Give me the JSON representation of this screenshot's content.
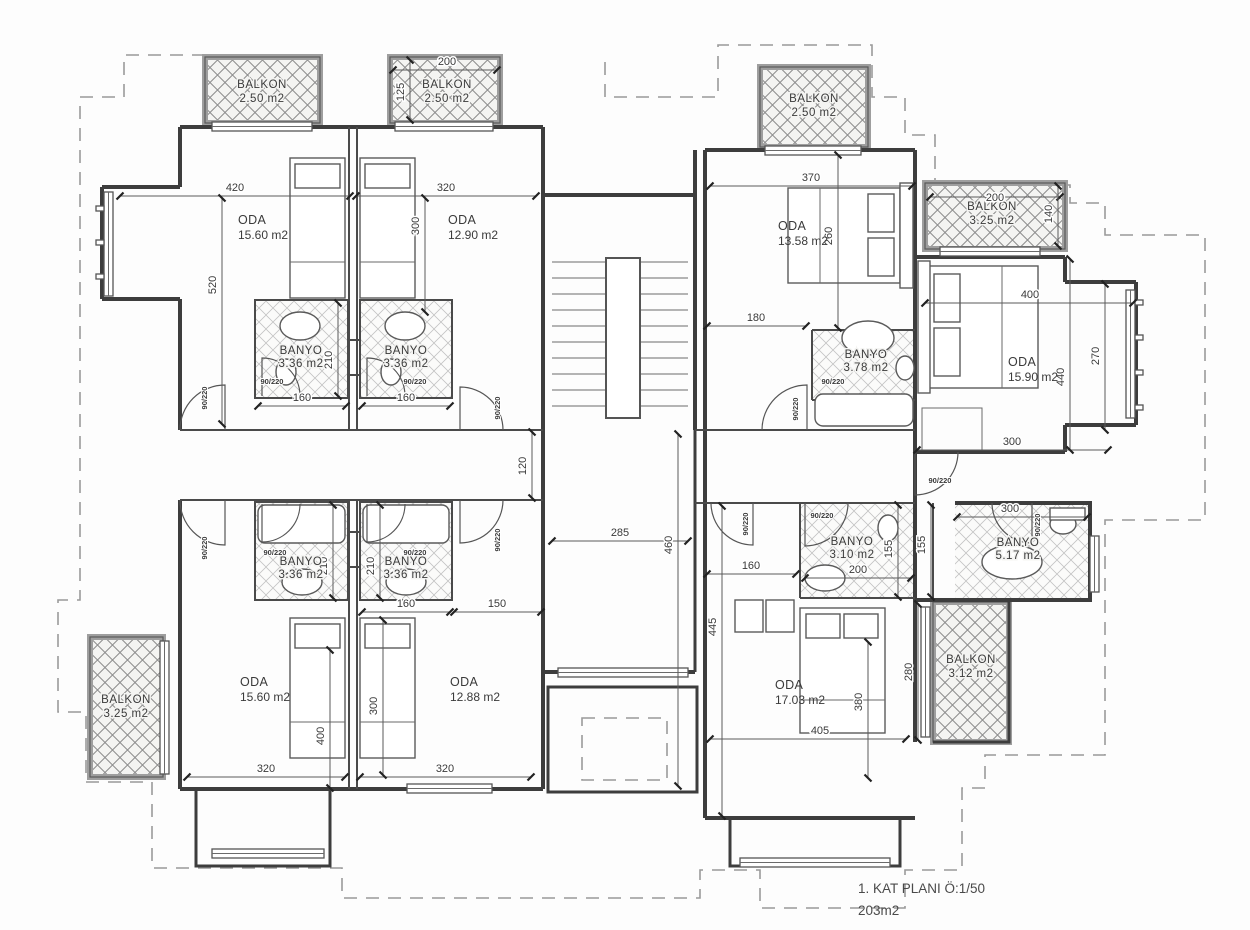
{
  "title": {
    "line1": "1. KAT PLANI Ö:1/50",
    "line2": "203m2"
  },
  "door_label": "90/220",
  "rooms": {
    "balkon_top1": {
      "name": "BALKON",
      "area": "2.50 m2"
    },
    "balkon_top2": {
      "name": "BALKON",
      "area": "2.50 m2"
    },
    "balkon_top3": {
      "name": "BALKON",
      "area": "2.50 m2"
    },
    "balkon_right": {
      "name": "BALKON",
      "area": "3.25 m2"
    },
    "balkon_left": {
      "name": "BALKON",
      "area": "3.25 m2"
    },
    "balkon_bottom_right": {
      "name": "BALKON",
      "area": "3.12 m2"
    },
    "oda_top_left": {
      "name": "ODA",
      "area": "15.60 m2"
    },
    "oda_top_mid": {
      "name": "ODA",
      "area": "12.90 m2"
    },
    "oda_top_right": {
      "name": "ODA",
      "area": "13.58 m2"
    },
    "oda_right": {
      "name": "ODA",
      "area": "15.90 m2"
    },
    "oda_bottom_left": {
      "name": "ODA",
      "area": "15.60 m2"
    },
    "oda_bottom_mid": {
      "name": "ODA",
      "area": "12.88 m2"
    },
    "oda_bottom_right": {
      "name": "ODA",
      "area": "17.03 m2"
    },
    "banyo_tl_1": {
      "name": "BANYO",
      "area": "3.36 m2"
    },
    "banyo_tl_2": {
      "name": "BANYO",
      "area": "3.36 m2"
    },
    "banyo_tr": {
      "name": "BANYO",
      "area": "3.78 m2"
    },
    "banyo_bl_1": {
      "name": "BANYO",
      "area": "3.36 m2"
    },
    "banyo_bl_2": {
      "name": "BANYO",
      "area": "3.36 m2"
    },
    "banyo_br_1": {
      "name": "BANYO",
      "area": "3.10 m2"
    },
    "banyo_br_2": {
      "name": "BANYO",
      "area": "5.17 m2"
    }
  },
  "dims": {
    "d420": "420",
    "d320a": "320",
    "d200_b2": "200",
    "d370": "370",
    "d200_b4": "200",
    "d180": "180",
    "d400_r": "400",
    "d300_r": "300",
    "d160a": "160",
    "d160b": "160",
    "d285": "285",
    "d150": "150",
    "d160c": "160",
    "d320c": "320",
    "d320d": "320",
    "d160d": "160",
    "d200_br": "200",
    "d300_br": "300",
    "d405": "405",
    "d520": "520",
    "d300v_tl": "300",
    "d125_b2": "125",
    "d260": "260",
    "d140": "140",
    "d440": "440",
    "d270": "270",
    "d460": "460",
    "d120": "120",
    "d210t": "210",
    "d210b1": "210",
    "d210b2": "210",
    "d300v_bl": "300",
    "d400v_bl": "400",
    "d445": "445",
    "d155a": "155",
    "d155b": "155",
    "d280": "280",
    "d380": "380"
  }
}
